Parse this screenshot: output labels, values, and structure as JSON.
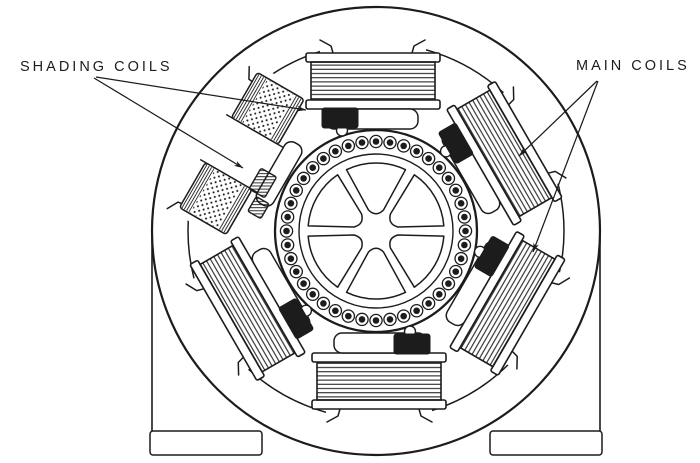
{
  "figure": {
    "kind": "shaded-pole motor cross-section line drawing",
    "colors": {
      "ink": "#1c1c1c",
      "paper": "#ffffff"
    }
  },
  "labels": {
    "shading_coils": "SHADING COILS",
    "main_coils": "MAIN COILS"
  },
  "annotations": {
    "shading_coils_arrow_targets": [
      "top-pole-shading-coil",
      "upper-left-pole-shading-coil"
    ],
    "main_coils_arrow_targets": [
      "upper-right-pole-main-coil",
      "lower-right-pole-main-coil"
    ]
  },
  "motor": {
    "pole_count": 6,
    "main_coil_count": 6,
    "shading_coil_count": 6,
    "rotor_bar_count": 40,
    "rotor_spoke_count": 6
  }
}
